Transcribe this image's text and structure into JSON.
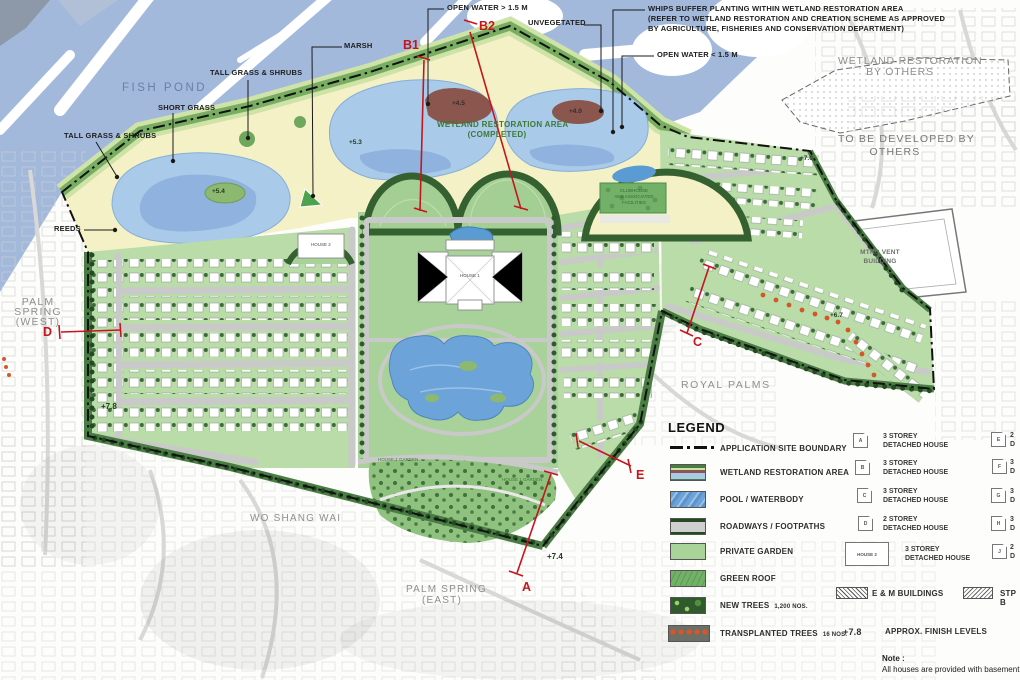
{
  "colors": {
    "accent_red": "#c4161c",
    "fishpond_blue": "#a2b9dc",
    "pond_blue": "#aacae9",
    "deep_water_blue": "#6ca3d8",
    "wetland_yellow": "#f4f1c6",
    "lot_green": "#b9dca8",
    "lawn_green": "#a9d29a",
    "dark_tree_green": "#2e5a2e",
    "island_brown": "#8a564d",
    "road_gray": "#c8c8c8",
    "transplanted_orange": "#d4572a"
  },
  "map": {
    "callouts": {
      "open_water_deep": "OPEN WATER > 1.5 M",
      "unvegetated": "UNVEGETATED",
      "whips_line1": "WHIPS BUFFER PLANTING WITHIN WETLAND RESTORATION AREA",
      "whips_line2": "(REFER TO WETLAND RESTORATION AND CREATION SCHEME AS APPROVED",
      "whips_line3": "BY AGRICULTURE, FISHERIES AND CONSERVATION DEPARTMENT)",
      "open_water_shallow": "OPEN WATER < 1.5 M",
      "marsh": "MARSH",
      "tall_grass_shrubs_top": "TALL GRASS & SHRUBS",
      "short_grass": "SHORT GRASS",
      "tall_grass_shrubs_left": "TALL GRASS & SHRUBS",
      "reeds": "REEDS"
    },
    "areas": {
      "fish_pond": "FISH POND",
      "wetland_completed_line1": "WETLAND RESTORATION AREA",
      "wetland_completed_line2": "(COMPLETED)",
      "wetland_by_others_line1": "WETLAND RESTORATION",
      "wetland_by_others_line2": "BY OTHERS",
      "to_be_developed_line1": "TO BE DEVELOPED BY",
      "to_be_developed_line2": "OTHERS",
      "mtrc_line1": "MTRC VENT",
      "mtrc_line2": "BUILDING",
      "palm_spring_west_line1": "PALM",
      "palm_spring_west_line2": "SPRING",
      "palm_spring_west_line3": "(WEST)",
      "palm_spring_east_line1": "PALM SPRING",
      "palm_spring_east_line2": "(EAST)",
      "royal_palms": "ROYAL PALMS",
      "wo_shang_wai": "WO SHANG WAI",
      "house_1": "HOUSE 1",
      "house_2": "HOUSE 2",
      "house_1_garden_a": "HOUSE 1 GARDEN",
      "house_1_garden_b": "HOUSE 1 GARDEN",
      "clubhouse_line1": "CLUBHOUSE",
      "clubhouse_line2": "AND ASSOCIATED",
      "clubhouse_line3": "FACILITIES"
    },
    "sections": {
      "a": "A",
      "b1": "B1",
      "b2": "B2",
      "c": "C",
      "d": "D",
      "e": "E"
    },
    "spot_levels": {
      "pond_west": "+5.4",
      "pond_small": "+5.3",
      "island_mid": "+4.5",
      "island_east": "+4.0",
      "northeast": "+7.0",
      "arm": "+6.7",
      "west_cluster": "+7.8",
      "south_garden": "+7.4"
    }
  },
  "legend": {
    "title": "LEGEND",
    "items": [
      {
        "label": "APPLICATION SITE BOUNDARY"
      },
      {
        "label": "WETLAND RESTORATION AREA"
      },
      {
        "label": "POOL / WATERBODY"
      },
      {
        "label": "ROADWAYS / FOOTPATHS"
      },
      {
        "label": "PRIVATE GARDEN"
      },
      {
        "label": "GREEN ROOF"
      },
      {
        "label": "NEW TREES",
        "qty": "1,200 NOS."
      },
      {
        "label": "TRANSPLANTED TREES",
        "qty": "16 NOS."
      }
    ],
    "finish_levels": {
      "symbol": "+7.8",
      "label": "APPROX. FINISH LEVELS"
    },
    "house_types_mid": [
      {
        "letter": "A",
        "line1": "3 STOREY",
        "line2": "DETACHED HOUSE"
      },
      {
        "letter": "B",
        "line1": "3 STOREY",
        "line2": "DETACHED HOUSE"
      },
      {
        "letter": "C",
        "line1": "3 STOREY",
        "line2": "DETACHED HOUSE"
      },
      {
        "letter": "D",
        "line1": "2 STOREY",
        "line2": "DETACHED HOUSE"
      },
      {
        "letter": "HOUSE 2",
        "line1": "3 STOREY",
        "line2": "DETACHED HOUSE"
      }
    ],
    "em_label": "E & M BUILDINGS",
    "house_types_right": [
      {
        "letter": "E",
        "line1": "2",
        "line2": "D"
      },
      {
        "letter": "F",
        "line1": "3",
        "line2": "D"
      },
      {
        "letter": "G",
        "line1": "3",
        "line2": "D"
      },
      {
        "letter": "H",
        "line1": "3",
        "line2": "D"
      },
      {
        "letter": "J",
        "line1": "2",
        "line2": "D"
      }
    ],
    "stp_label": "STP B"
  },
  "note": {
    "heading": "Note :",
    "body": "All houses are provided with basement c"
  }
}
